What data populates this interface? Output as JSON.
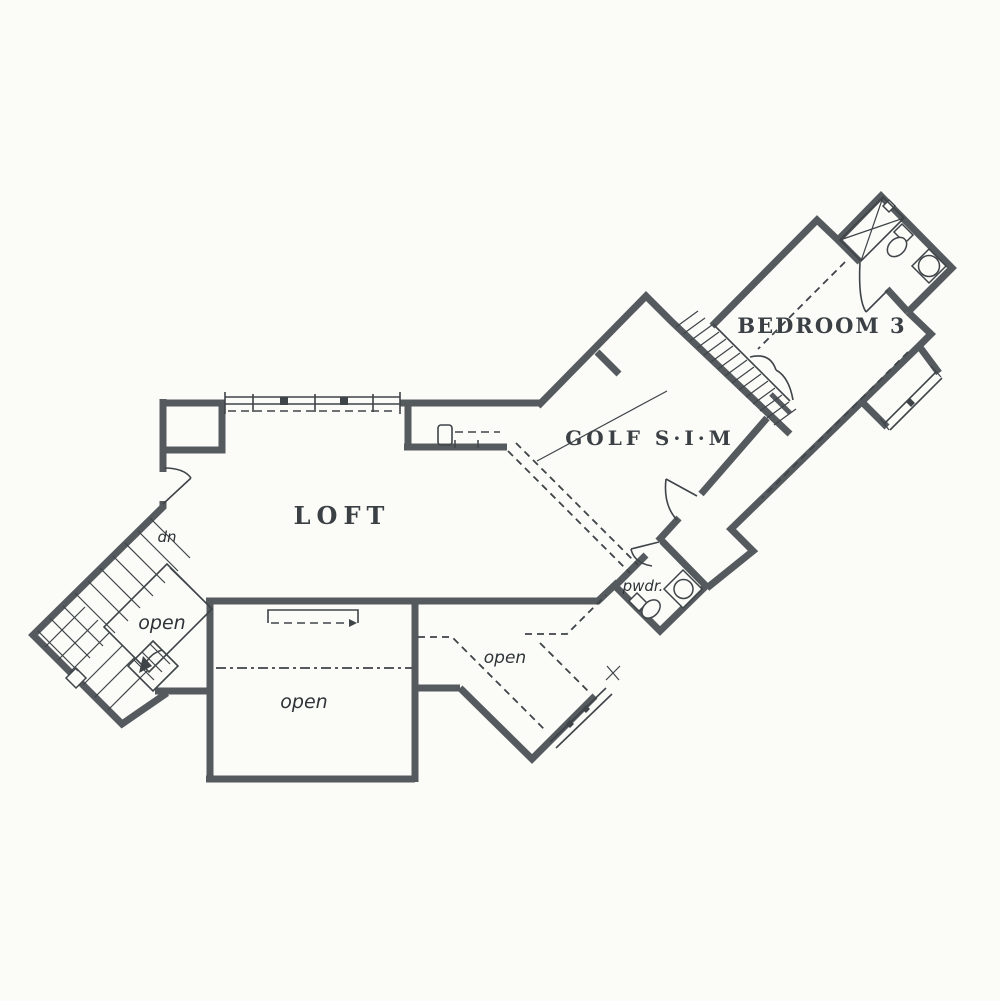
{
  "plan": {
    "type": "floor-plan",
    "rooms": {
      "loft": "LOFT",
      "golf_sim": "GOLF S·I·M",
      "bedroom3": "BEDROOM 3",
      "powder": "pwdr.",
      "open_stair": "open",
      "open_below_loft": "open",
      "open_mid": "open",
      "stair_direction": "dn"
    },
    "colors": {
      "wall": "#545a5e",
      "line": "#3f4448",
      "paper": "#fbfbf8",
      "text": "#3b4045"
    }
  }
}
